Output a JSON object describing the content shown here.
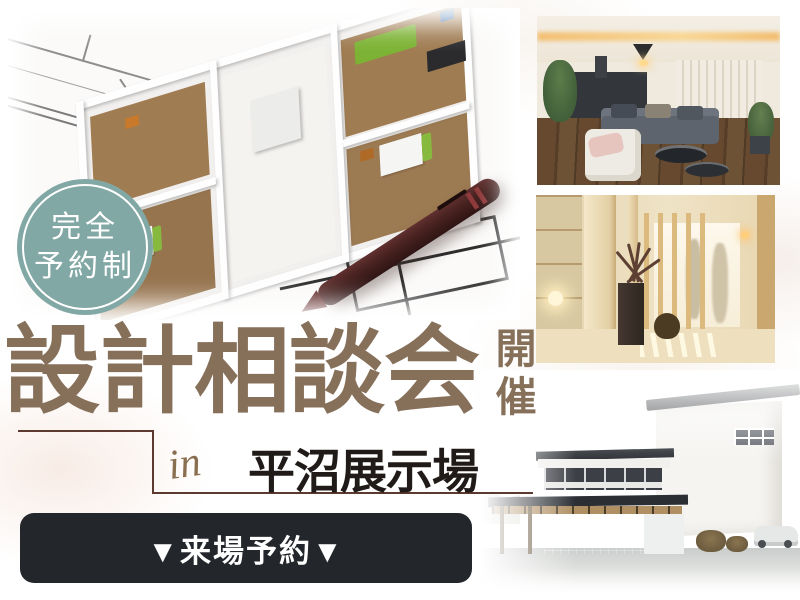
{
  "badge": {
    "line1": "完全",
    "line2": "予約制"
  },
  "title": {
    "main": "設計相談会",
    "sub_vertical": "開催"
  },
  "location": {
    "prefix": "in",
    "name": "平沼展示場"
  },
  "cta": {
    "label": "▼来場予約▼"
  },
  "photos": {
    "floorplan": {
      "name": "3d-floorplan-photo"
    },
    "living": {
      "name": "living-room-photo"
    },
    "entrance": {
      "name": "entrance-hall-photo"
    },
    "exterior": {
      "name": "house-exterior-photo"
    }
  },
  "colors": {
    "badge_teal": "#82a8a5",
    "title_brown": "#86705a",
    "frame_line_brown": "#5d3a30",
    "location_text": "#201b18",
    "cta_background": "#23262b",
    "cta_text": "#ffffff"
  }
}
